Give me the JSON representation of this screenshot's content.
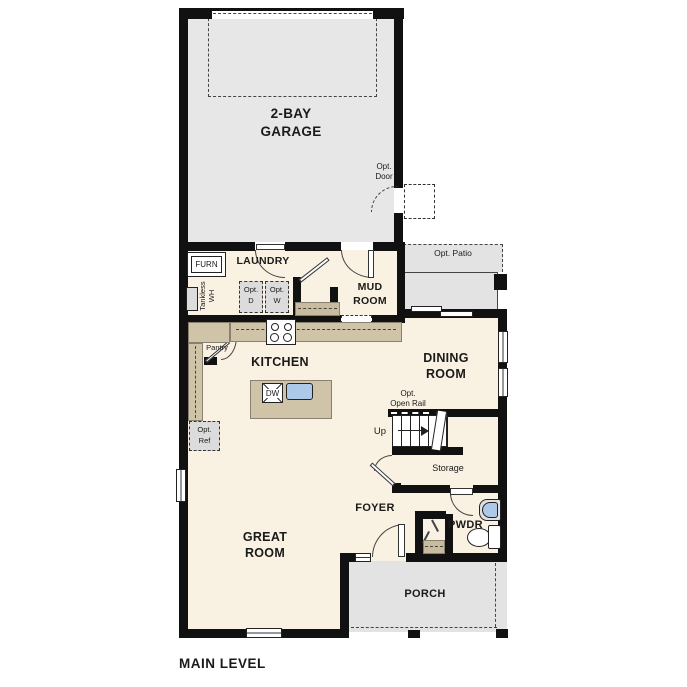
{
  "plan_title": "MAIN LEVEL",
  "rooms": {
    "garage": "2-BAY\nGARAGE",
    "laundry": "LAUNDRY",
    "mud_room": "MUD\nROOM",
    "kitchen": "KITCHEN",
    "dining_room": "DINING\nROOM",
    "great_room": "GREAT\nROOM",
    "foyer": "FOYER",
    "powder_room": "PWDR",
    "storage": "Storage",
    "porch": "PORCH"
  },
  "annotations": {
    "opt_door": "Opt.\nDoor",
    "opt_patio": "Opt. Patio",
    "opt_open_rail": "Opt.\nOpen Rail",
    "opt_dryer": "Opt.\nD",
    "opt_washer": "Opt.\nW",
    "opt_ref": "Opt.\nRef",
    "pantry": "Pantry",
    "furnace": "FURN",
    "tankless_wh": "Tankless\nWH",
    "dishwasher": "DW",
    "stairs_up": "Up"
  },
  "colors": {
    "wall": "#111111",
    "interior_floor": "#f9f1e2",
    "garage_floor": "#e7e7e7",
    "patio_floor": "#e3e3e3",
    "counter_tan": "#d0c4a8",
    "fixture_blue": "#adc9e9",
    "optional_fill": "#dcdcdc"
  }
}
